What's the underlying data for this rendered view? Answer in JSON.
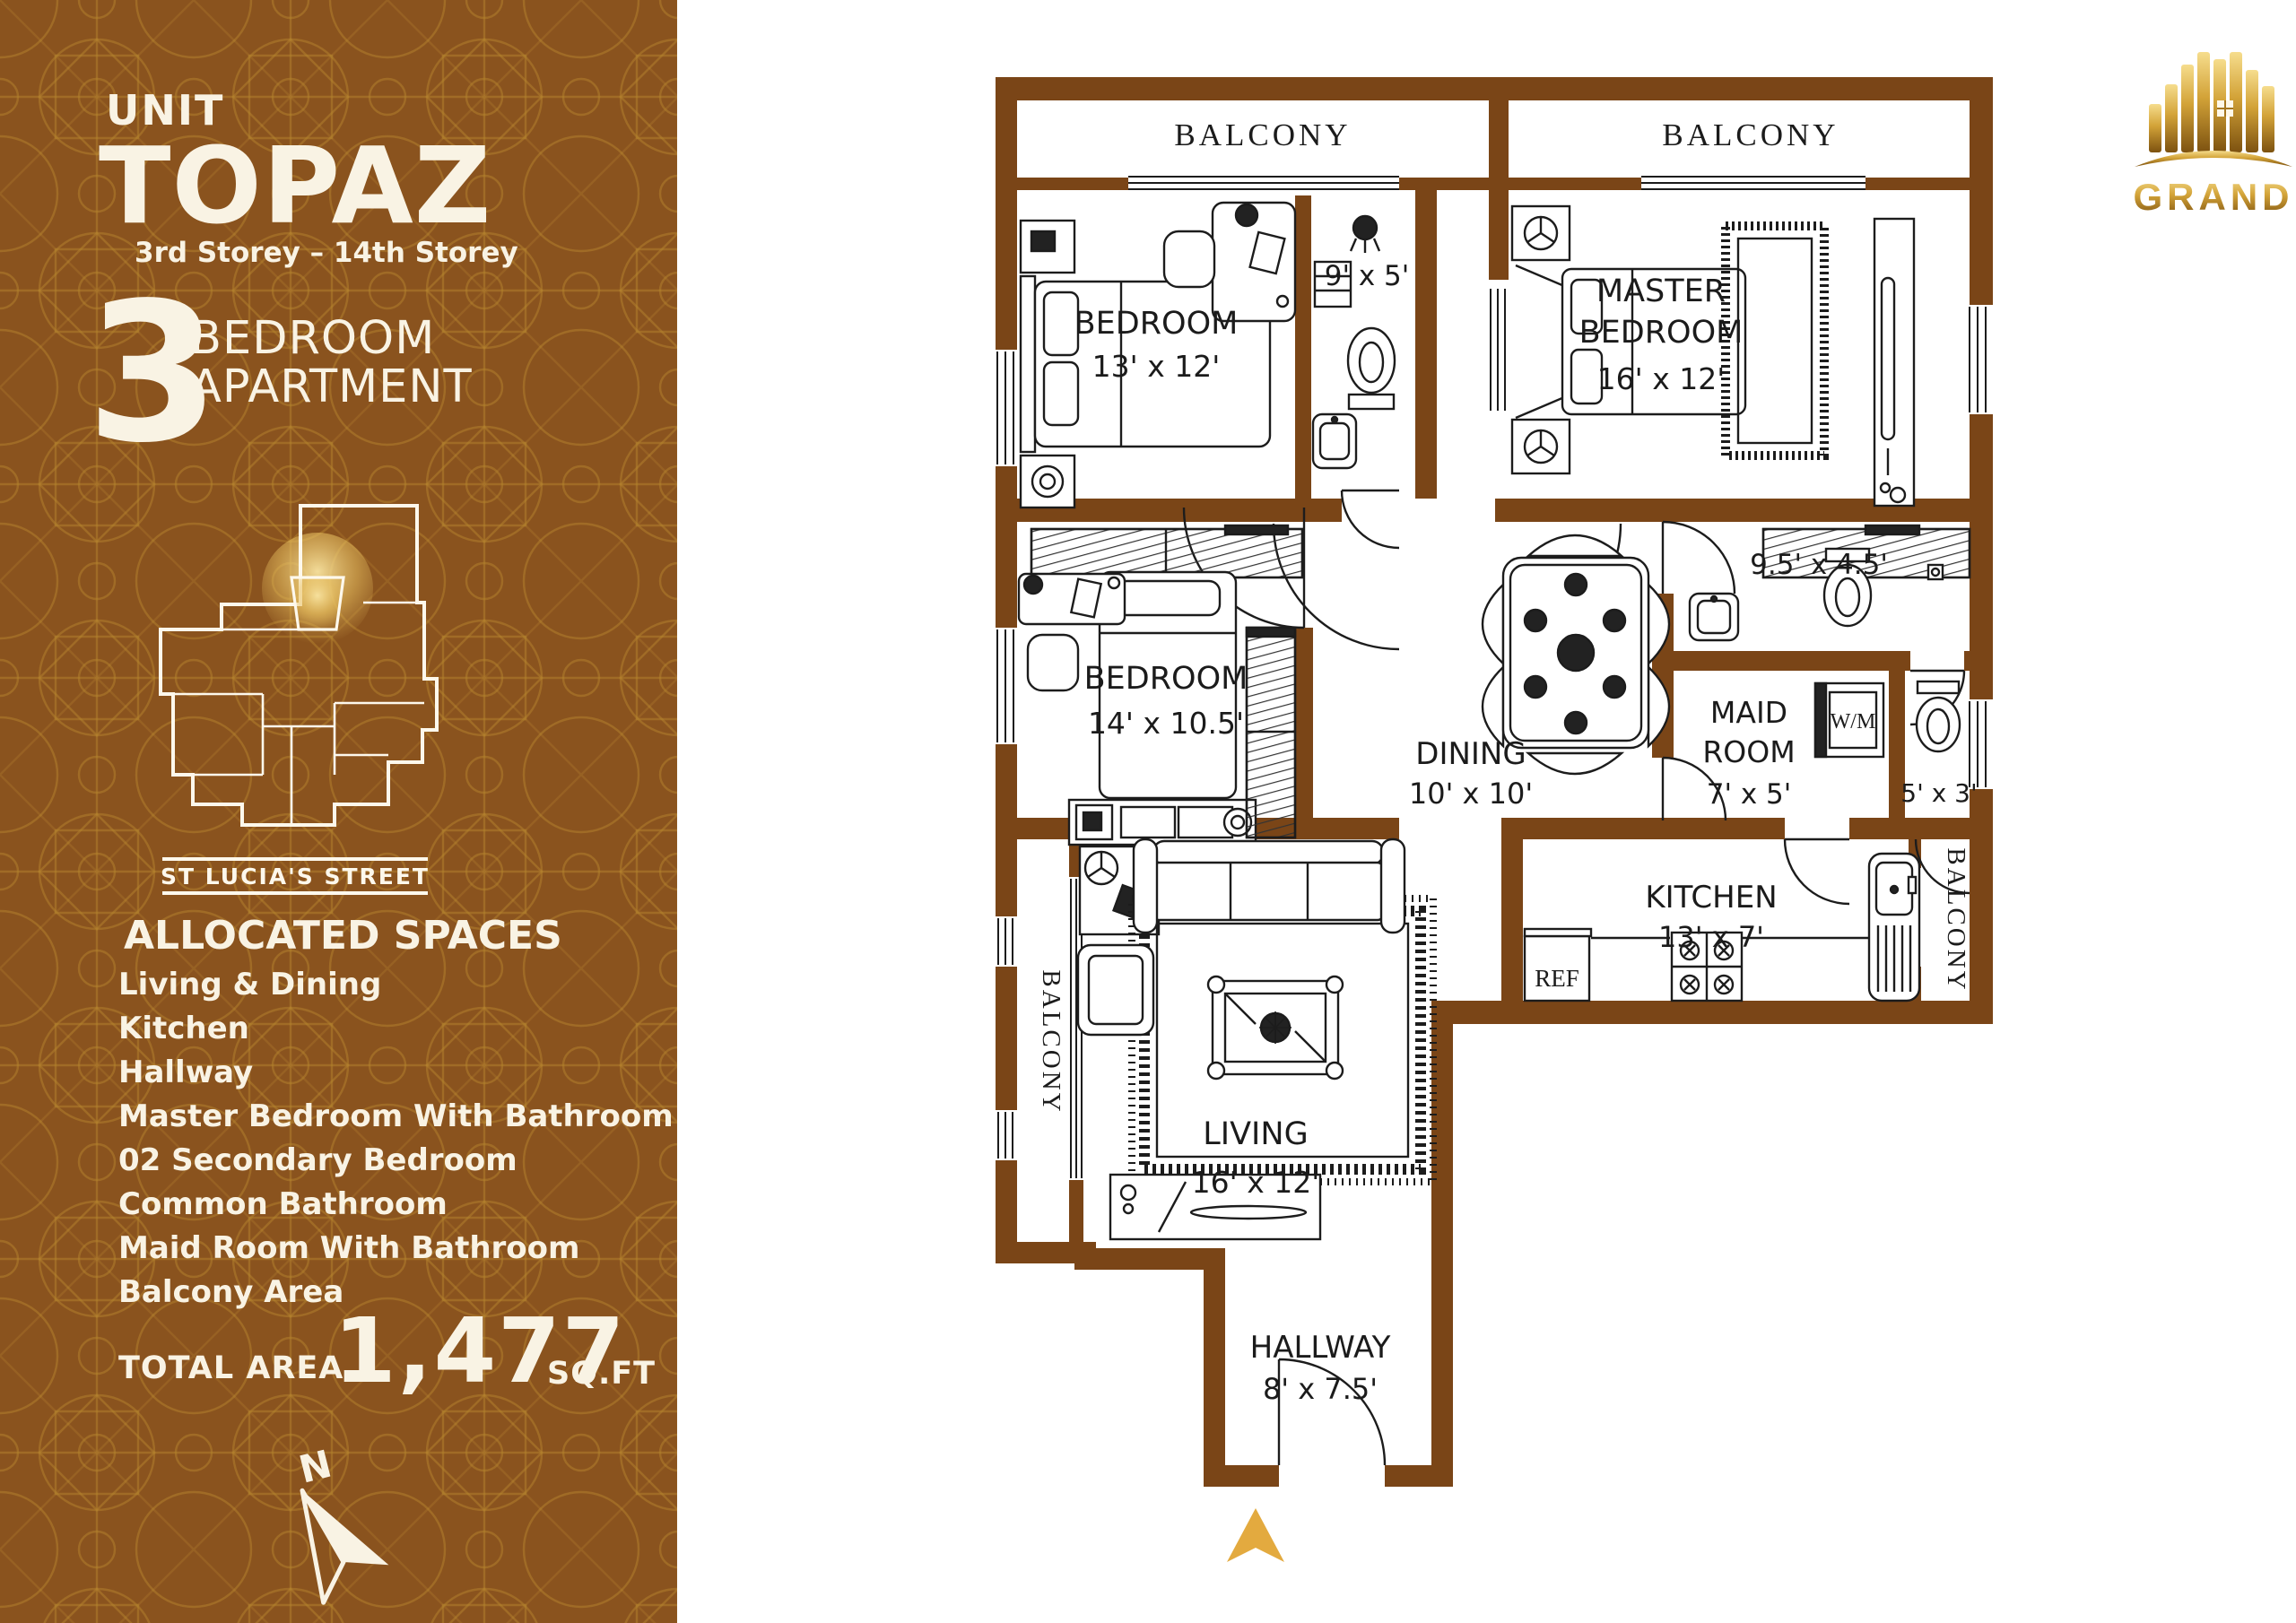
{
  "brand": {
    "name": "GRAND"
  },
  "header": {
    "unit_label": "UNIT",
    "unit_name": "TOPAZ",
    "storey_range": "3rd Storey – 14th Storey",
    "bedroom_count": "3",
    "type_line1": "BEDROOM",
    "type_line2": "APARTMENT"
  },
  "site_map": {
    "street_name": "ST LUCIA'S STREET"
  },
  "allocated_spaces": {
    "heading": "ALLOCATED SPACES",
    "items": [
      "Living & Dining",
      "Kitchen",
      "Hallway",
      "Master Bedroom With Bathroom",
      "02 Secondary Bedroom",
      "Common Bathroom",
      "Maid Room With Bathroom",
      "Balcony Area"
    ]
  },
  "total_area": {
    "label": "TOTAL AREA",
    "value": "1,477",
    "unit": "SQ.FT"
  },
  "compass": {
    "north_label": "N"
  },
  "floor_plan": {
    "balcony_top_left": "BALCONY",
    "balcony_top_right": "BALCONY",
    "balcony_side_left": "BALCONY",
    "balcony_side_right": "BALCONY",
    "bedroom_1": {
      "name": "BEDROOM",
      "dims": "13' x 12'"
    },
    "bathroom_1": {
      "dims": "9' x 5'"
    },
    "master_bedroom": {
      "name_line1": "MASTER",
      "name_line2": "BEDROOM",
      "dims": "16' x 12'"
    },
    "bedroom_2": {
      "name": "BEDROOM",
      "dims": "14' x 10.5'"
    },
    "bathroom_2": {
      "dims": "9.5' x 4.5'"
    },
    "maid_room": {
      "name_line1": "MAID",
      "name_line2": "ROOM",
      "dims": "7' x 5'"
    },
    "washing_machine": "W/M",
    "wc": {
      "dims": "5' x 3'"
    },
    "dining": {
      "name": "DINING",
      "dims": "10' x 10'"
    },
    "kitchen": {
      "name": "KITCHEN",
      "dims": "13' x 7'"
    },
    "refrigerator": "REF",
    "living": {
      "name": "LIVING",
      "dims": "16' x 12'"
    },
    "hallway": {
      "name": "HALLWAY",
      "dims": "8' x 7.5'"
    }
  },
  "colors": {
    "sidebar_bg": "#8a531e",
    "pattern_line": "#b5842d",
    "wall": "#7a4517",
    "gold": "#e3aa3f",
    "light_text": "#f9f3e4"
  }
}
